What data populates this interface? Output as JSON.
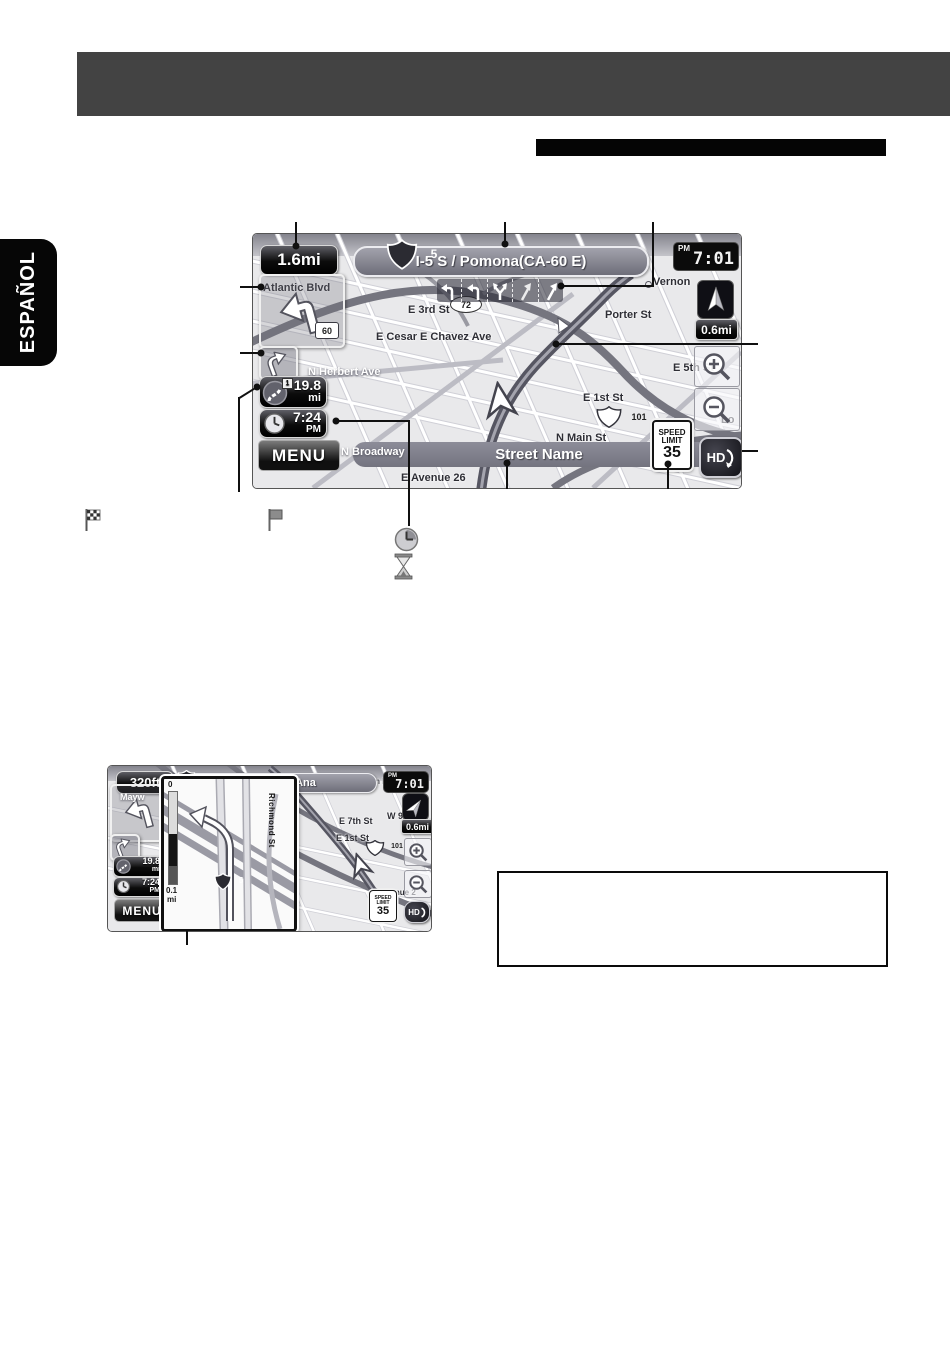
{
  "sidebar": {
    "language_tab": "ESPAÑOL"
  },
  "legend": {
    "icons": [
      "finish-flag-icon",
      "waypoint-flag-icon",
      "clock-icon",
      "hourglass-icon"
    ]
  },
  "main_screen": {
    "turn_distance": "1.6mi",
    "shield": "5",
    "route_name": "I-5 S / Pomona(CA-60 E)",
    "clock_period": "PM",
    "clock_time": "7:01",
    "compass_scale": "0.6mi",
    "turn_shield": "60",
    "oval_shield": "72",
    "dest_distance_value": "19.8",
    "dest_distance_unit": "mi",
    "waypoint_number": "1",
    "arrival_time": "7:24",
    "arrival_period": "PM",
    "menu_label": "MENU",
    "street_name": "Street Name",
    "speed_limit_line1": "SPEED",
    "speed_limit_line2": "LIMIT",
    "speed_limit_value": "35",
    "hd_label": "HD",
    "labels": {
      "atlantic": "Atlantic Blvd",
      "e3rd": "E 3rd St",
      "chavez": "E Cesar E Chavez Ave",
      "herbert": "N Herbert Ave",
      "porter": "Porter St",
      "vernon": "Vernon",
      "e1st": "E 1st St",
      "us101": "101",
      "nmain": "N Main St",
      "broadway": "N Broadway",
      "ave26": "E Avenue 26",
      "e5th": "E 5th St",
      "lo": "Lo"
    }
  },
  "junction_screen": {
    "turn_distance": "320ft",
    "shield": "5",
    "route_name": "I-5 S / Santa Ana",
    "clock_period": "PM",
    "clock_time": "7:01",
    "compass_scale": "0.6mi",
    "dest_distance_value": "19.8",
    "dest_distance_unit": "mi",
    "arrival_time": "7:24",
    "arrival_period": "PM",
    "menu_label": "MENU",
    "speed_limit_line1": "SPEED",
    "speed_limit_line2": "LIMIT",
    "speed_limit_value": "35",
    "hd_label": "HD",
    "inset": {
      "bar_top": "0",
      "bar_value": "0.1",
      "bar_unit": "mi",
      "street": "Richmond St",
      "shield": "5"
    },
    "labels": {
      "jefferson": "Jefferson Blvd",
      "e7th": "E 7th St",
      "w9th": "W 9th St",
      "e1st": "E 1st St",
      "us101": "101",
      "avenue": "venue 2",
      "mayw": "Mayw"
    }
  }
}
